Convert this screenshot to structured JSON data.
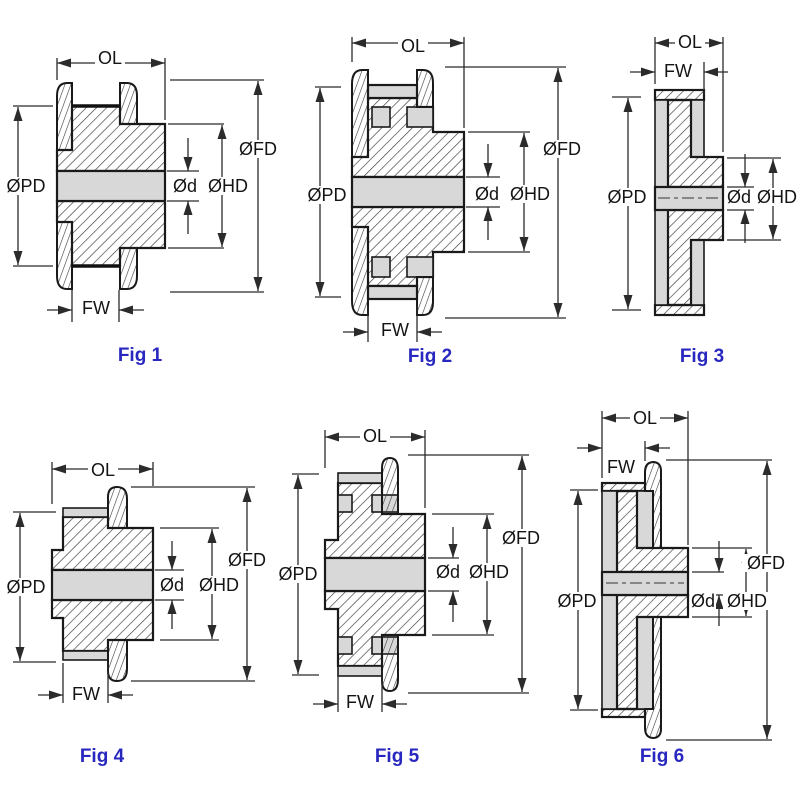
{
  "page": {
    "background": "#ffffff",
    "description_type": "technical-drawing"
  },
  "dim_labels": {
    "ol": "OL",
    "fw": "FW",
    "pd": "ØPD",
    "fd": "ØFD",
    "hd": "ØHD",
    "d": "Ød"
  },
  "figures": [
    {
      "caption": "Fig 1"
    },
    {
      "caption": "Fig 2"
    },
    {
      "caption": "Fig 3"
    },
    {
      "caption": "Fig 4"
    },
    {
      "caption": "Fig 5"
    },
    {
      "caption": "Fig 6"
    }
  ],
  "colors": {
    "caption_blue": "#2828c0",
    "line_dark": "#1a1a1a",
    "dimension_line": "#2b2b2b",
    "fill_gray": "#d8d8d8",
    "background": "#ffffff"
  }
}
